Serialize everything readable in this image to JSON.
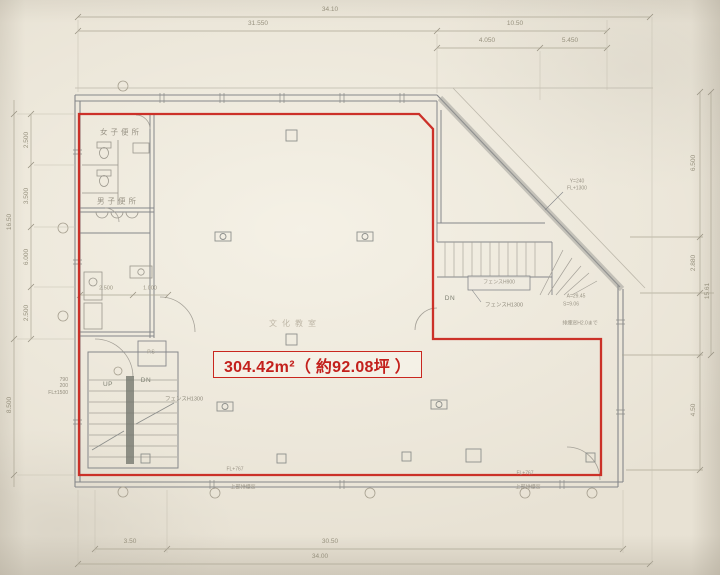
{
  "area_label": {
    "text": "304.42m²（ 約92.08坪 ）"
  },
  "rooms": {
    "womens_toilet": "女子便所",
    "mens_toilet": "男子便所",
    "classroom": "文化教室",
    "pipe_space": "P.S"
  },
  "stairs": {
    "up": "UP",
    "down_left": "DN",
    "down_right": "DN"
  },
  "annotations": {
    "fence_h900": "フェンスH900",
    "fence_h1300_right": "フェンスH1300",
    "fence_h1300_left": "フェンスH1300",
    "parapet_line1": "Y=240",
    "parapet_line2": "FL+1300",
    "calc_line1": "A=29.45",
    "calc_line2": "S=9.06",
    "smoke_window_note": "排煙窓H2.0まで",
    "top_smoke_left": "上部排煙窓",
    "top_smoke_right": "上部排煙窓",
    "sill_left": "FL+767",
    "sill_right": "FL+767",
    "left_note_line1": "790",
    "left_note_line2": "200",
    "left_note_line3": "FL±1500"
  },
  "dimensions": {
    "top_overall": "34.10",
    "top_span": "31.550",
    "top_right_span": "10.50",
    "top_right_a": "4.050",
    "top_right_b": "5.450",
    "left_overall": "16.50",
    "left_lower": "8.500",
    "left_a": "2.500",
    "left_b": "3.500",
    "left_c": "6.000",
    "left_d": "2.500",
    "right_a": "6.500",
    "right_b": "2.880",
    "right_overall": "15.61",
    "right_lower": "4.50",
    "bottom_a": "3.50",
    "bottom_b": "30.50",
    "bottom_overall": "34.00",
    "inner_a": "2.500",
    "inner_b": "1.000"
  },
  "colors": {
    "highlight_red": "#c9271f",
    "pencil_gray": "#85878a",
    "paper": "#e8e2d4"
  }
}
